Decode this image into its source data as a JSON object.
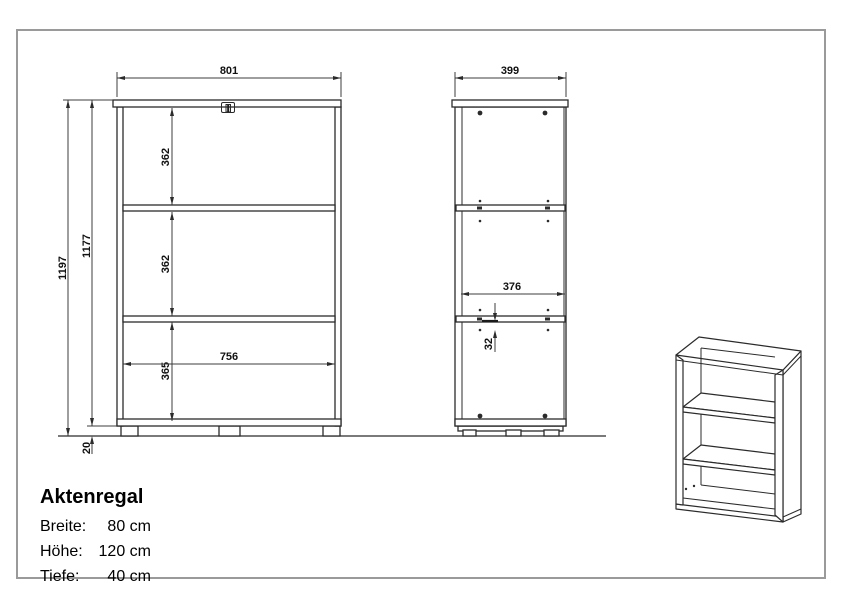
{
  "info": {
    "title": "Aktenregal",
    "specs": [
      {
        "label": "Breite:",
        "value": "80 cm"
      },
      {
        "label": "Höhe:",
        "value": "120 cm"
      },
      {
        "label": "Tiefe:",
        "value": "40 cm"
      }
    ]
  },
  "front_view": {
    "width": "801",
    "inner_width": "756",
    "total_height": "1197",
    "body_height": "1177",
    "compartment_top": "362",
    "compartment_middle": "362",
    "compartment_bottom": "365",
    "base_height": "20"
  },
  "side_view": {
    "depth": "399",
    "inner_depth": "376",
    "shelf_offset": "32"
  },
  "colors": {
    "line": "#2b2b2b",
    "dimension": "#3c3c3c",
    "frame": "#9a9a9a",
    "background": "#ffffff"
  }
}
